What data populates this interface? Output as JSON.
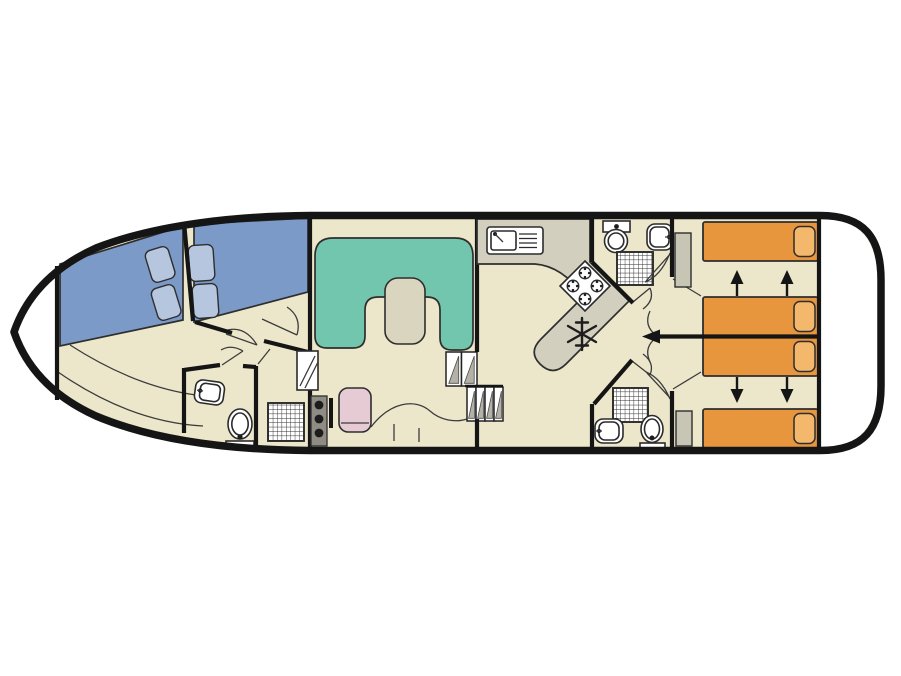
{
  "plan": {
    "title": "Canal cruiser deck plan, top view",
    "orientation": "bow left, stern right",
    "sections": [
      {
        "name": "fore deck",
        "items": []
      },
      {
        "name": "bow cabin",
        "items": [
          "double berth port",
          "double berth starboard",
          "4 pillows",
          "wardrobe"
        ]
      },
      {
        "name": "bow bathroom",
        "items": [
          "sink",
          "toilet",
          "shower"
        ]
      },
      {
        "name": "saloon",
        "items": [
          "U-shaped sofa",
          "table",
          "helm seat",
          "helm console with 3 gauges",
          "steering wheel",
          "dashboard"
        ]
      },
      {
        "name": "companionway",
        "items": [
          "2 upper steps",
          "4 lower steps"
        ]
      },
      {
        "name": "galley",
        "items": [
          "sink with drainer",
          "4-burner hob",
          "refrigerator"
        ]
      },
      {
        "name": "mid bathroom top",
        "items": [
          "toilet with cistern",
          "sink",
          "shower"
        ]
      },
      {
        "name": "mid bathroom bottom",
        "items": [
          "shower",
          "sink",
          "toilet"
        ]
      },
      {
        "name": "stern cabins",
        "items": [
          "4 single beds with pillows",
          "2 wardrobes",
          "sliding center partition"
        ]
      },
      {
        "name": "aft deck",
        "items": []
      }
    ],
    "bed_conversion": "middle two beds slide apart (up/down arrows), center wall arrow points left"
  },
  "icons": {
    "fridge_icon": "snowflake",
    "hob_icon": "4 gas burners",
    "shower_icon": "grid mesh square",
    "toilet_icon": "oval bowl with dot",
    "sink_icon": "basin with faucet dot",
    "steering_wheel_icon": "vertical black bar",
    "gauge_icon": "black circle",
    "slide_arrow_up": "black arrow up",
    "slide_arrow_down": "black arrow down",
    "partition_arrow_left": "black arrow left",
    "door_swing": "thin quarter arc"
  },
  "colors": {
    "floor": "#ece7cb",
    "deck": "#ffffff",
    "wall": "#151515",
    "bed_blue": "#7b9ac8",
    "bed_blue_light": "#b6c6de",
    "bed_orange": "#e8963e",
    "bed_orange_light": "#f3b86c",
    "sofa": "#73c6ae",
    "table": "#d9d5bf",
    "counter": "#d2cfbe",
    "seat": "#e6cbd5",
    "wardrobe": "#c7c5b4",
    "console": "#8f8d83",
    "step_tread": "#b4b2a6",
    "fixture": "#ffffff"
  }
}
